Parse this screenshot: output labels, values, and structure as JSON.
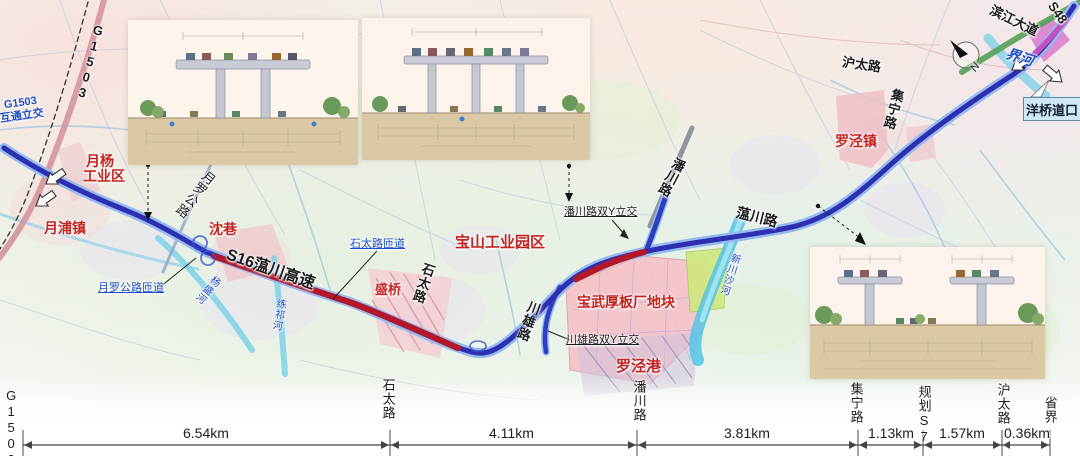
{
  "map": {
    "labels": {
      "g1503_road": "G1503",
      "g1503_interchange_line1": "G1503",
      "g1503_interchange_line2": "互通立交",
      "yueyang_zone_line1": "月杨",
      "yueyang_zone_line2": "工业区",
      "yuepu_town": "月浦镇",
      "yueluo_road": "月罗公路",
      "shenxiang": "沈巷",
      "s16_expressway": "S16蕰川高速",
      "yueluo_ramp": "月罗公路匝道",
      "yangsheng_river": "杨盛河",
      "lianqi_river": "练祁河",
      "shitai_ramp": "石太路匝道",
      "shengqiao": "盛桥",
      "shitai_road": "石太路",
      "baoshan_industrial_park": "宝山工业园区",
      "chuanxiong_road": "川雄路",
      "chuanxiong_interchange": "川雄路双Y立交",
      "baowu_plate_plant": "宝武厚板厂地块",
      "luojing_port": "罗泾港",
      "panchuan_interchange": "潘川路双Y立交",
      "panchuan_road": "潘川路",
      "wenchuan_road": "蕰川路",
      "xinchuansha_river": "新川沙河",
      "luojing_town": "罗泾镇",
      "hutai_road": "沪太路",
      "jining_road": "集宁路",
      "binjiang_avenue": "滨江大道",
      "s48_road": "S48",
      "jie_river": "界河",
      "yangqiao_toll": "洋桥道口",
      "compass_n": "N"
    }
  },
  "scale_bar": {
    "boundaries": [
      "G1503",
      "石太路",
      "潘川路",
      "集宁路",
      "规划S7",
      "沪太路",
      "省界"
    ],
    "distances": [
      "6.54km",
      "4.11km",
      "3.81km",
      "1.13km",
      "1.57km",
      "0.36km"
    ]
  }
}
